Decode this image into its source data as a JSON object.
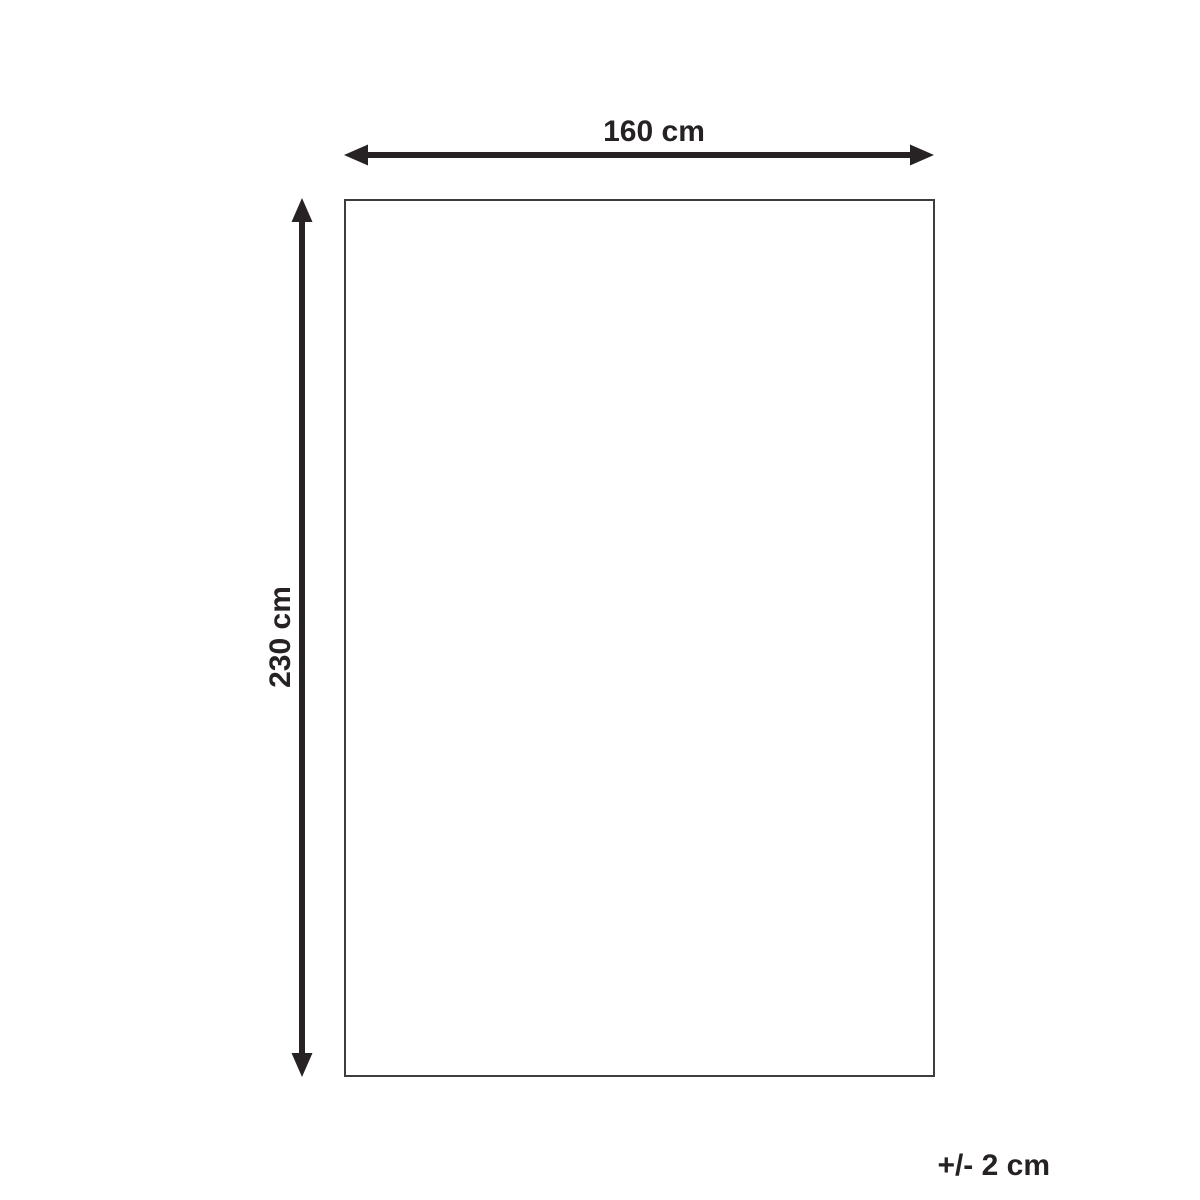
{
  "diagram": {
    "type": "product-dimension-diagram",
    "width_label": "160 cm",
    "height_label": "230 cm",
    "tolerance_label": "+/- 2 cm"
  },
  "colors": {
    "line_color": "#272324",
    "outline_color": "#3d3d3d",
    "background": "#ffffff",
    "text_color": "#262223"
  }
}
